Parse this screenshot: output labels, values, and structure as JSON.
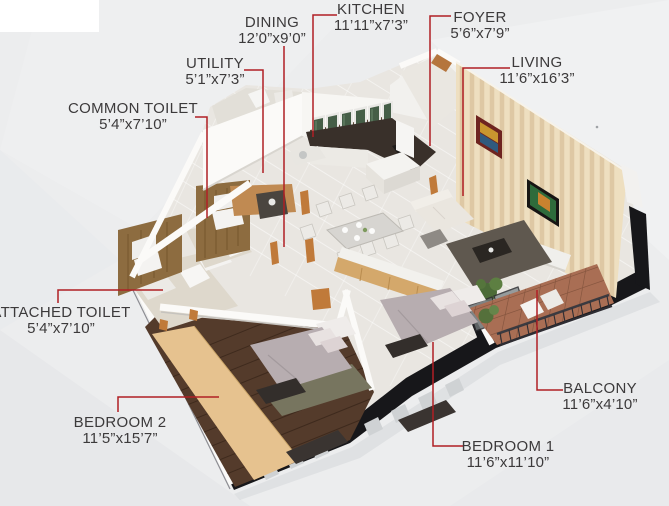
{
  "figure": {
    "type": "3d-isometric-floor-plan",
    "background_color": "#ecedee",
    "leader_line_color": "#b01f24",
    "label_text_color": "#3c3a3b",
    "blackout_edge_color": "#17171a"
  },
  "floorplan": {
    "rooms": [
      {
        "id": "dining",
        "name": "DINING",
        "dims": "12’0”x9’0”"
      },
      {
        "id": "kitchen",
        "name": "KITCHEN",
        "dims": "11’11”x7’3”"
      },
      {
        "id": "foyer",
        "name": "FOYER",
        "dims": "5’6”x7’9”"
      },
      {
        "id": "utility",
        "name": "UTILITY",
        "dims": "5’1”x7’3”"
      },
      {
        "id": "living",
        "name": "LIVING",
        "dims": "11’6”x16’3”"
      },
      {
        "id": "common-toilet",
        "name": "COMMON TOILET",
        "dims": "5’4”x7’10”"
      },
      {
        "id": "attached-toilet",
        "name": "ATTACHED TOILET",
        "dims": "5’4”x7’10”"
      },
      {
        "id": "bedroom-2",
        "name": "BEDROOM 2",
        "dims": "11’5”x15’7”"
      },
      {
        "id": "bedroom-1",
        "name": "BEDROOM 1",
        "dims": "11’6”x11’10”"
      },
      {
        "id": "balcony",
        "name": "BALCONY",
        "dims": "11’6”x4’10”"
      }
    ]
  }
}
